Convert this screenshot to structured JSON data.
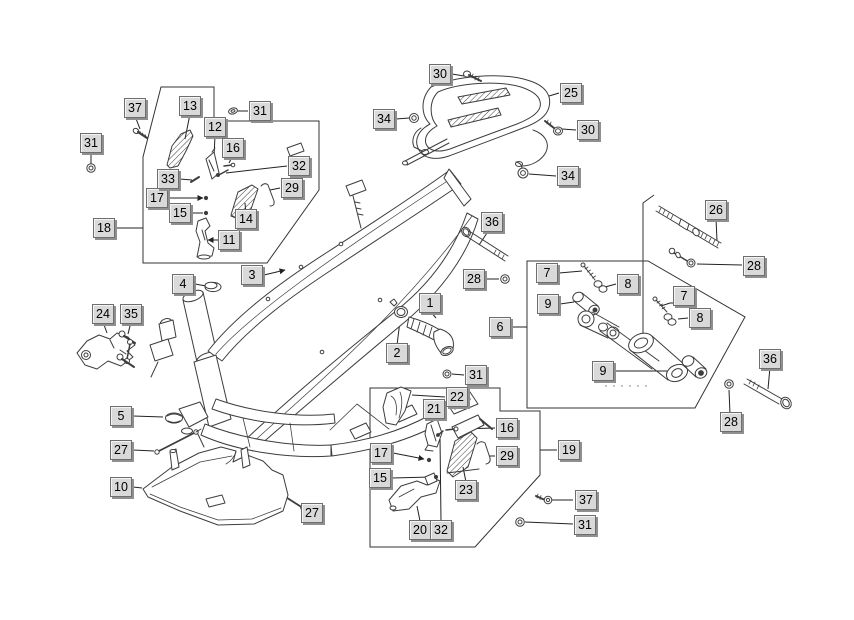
{
  "figure": {
    "kind": "exploded-parts-diagram",
    "background": "#ffffff",
    "line_color": "#3d3d3d"
  },
  "callout_style": {
    "fill": "#d9d9d9",
    "border": "#6e6e6e",
    "shadow": "#8f8f8f",
    "text": "#000000"
  },
  "callouts": {
    "c1": "1",
    "c2": "2",
    "c3": "3",
    "c4": "4",
    "c5": "5",
    "c6": "6",
    "c7a": "7",
    "c7b": "7",
    "c8a": "8",
    "c8b": "8",
    "c9a": "9",
    "c9b": "9",
    "c10": "10",
    "c11": "11",
    "c12": "12",
    "c13": "13",
    "c14": "14",
    "c15a": "15",
    "c15b": "15",
    "c16a": "16",
    "c16b": "16",
    "c17a": "17",
    "c17b": "17",
    "c18": "18",
    "c19": "19",
    "c20": "20",
    "c21": "21",
    "c22": "22",
    "c23": "23",
    "c24": "24",
    "c25": "25",
    "c26": "26",
    "c27a": "27",
    "c27b": "27",
    "c28a": "28",
    "c28b": "28",
    "c28c": "28",
    "c29a": "29",
    "c29b": "29",
    "c30a": "30",
    "c30b": "30",
    "c31a": "31",
    "c31b": "31",
    "c31c": "31",
    "c31d": "31",
    "c32a": "32",
    "c32b": "32",
    "c33": "33",
    "c34a": "34",
    "c34b": "34",
    "c35": "35",
    "c36a": "36",
    "c36b": "36",
    "c37a": "37",
    "c37b": "37"
  }
}
